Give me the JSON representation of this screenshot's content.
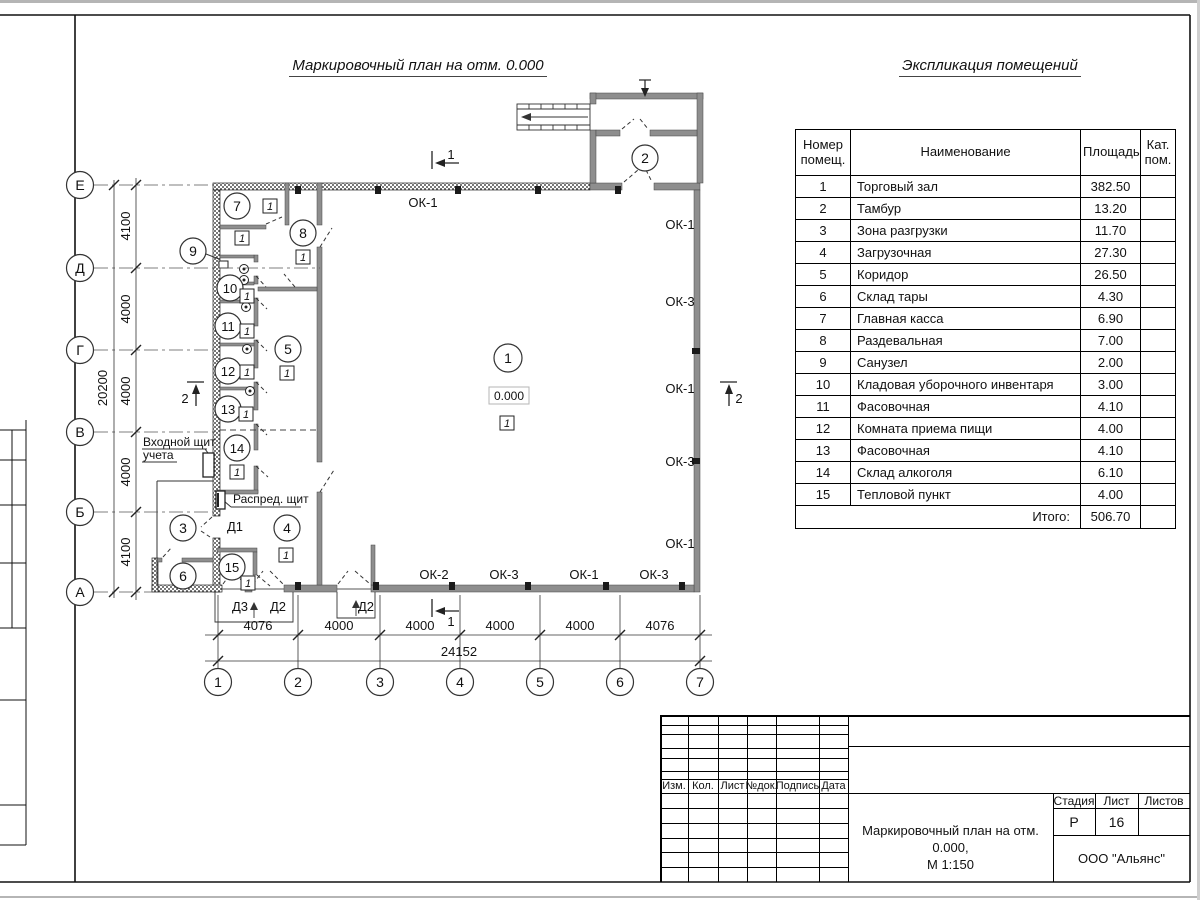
{
  "titles": {
    "plan": "Маркировочный план на отм. 0.000",
    "explication": "Экспликация помещений"
  },
  "explication": {
    "header": {
      "number": "Номер помещ.",
      "name": "Наименование",
      "area": "Площадь",
      "category": "Кат. пом."
    },
    "rows": [
      {
        "n": "1",
        "name": "Торговый зал",
        "area": "382.50"
      },
      {
        "n": "2",
        "name": "Тамбур",
        "area": "13.20"
      },
      {
        "n": "3",
        "name": "Зона разгрузки",
        "area": "11.70"
      },
      {
        "n": "4",
        "name": "Загрузочная",
        "area": "27.30"
      },
      {
        "n": "5",
        "name": "Коридор",
        "area": "26.50"
      },
      {
        "n": "6",
        "name": "Склад тары",
        "area": "4.30"
      },
      {
        "n": "7",
        "name": "Главная касса",
        "area": "6.90"
      },
      {
        "n": "8",
        "name": "Раздевальная",
        "area": "7.00"
      },
      {
        "n": "9",
        "name": "Санузел",
        "area": "2.00"
      },
      {
        "n": "10",
        "name": "Кладовая уборочного инвентаря",
        "area": "3.00"
      },
      {
        "n": "11",
        "name": "Фасовочная",
        "area": "4.10"
      },
      {
        "n": "12",
        "name": "Комната приема пищи",
        "area": "4.00"
      },
      {
        "n": "13",
        "name": "Фасовочная",
        "area": "4.10"
      },
      {
        "n": "14",
        "name": "Склад алкоголя",
        "area": "6.10"
      },
      {
        "n": "15",
        "name": "Тепловой пункт",
        "area": "4.00"
      }
    ],
    "total_label": "Итого:",
    "total_value": "506.70"
  },
  "plan": {
    "elevation": "0.000",
    "door_tag": "1",
    "axes_bottom": [
      "1",
      "2",
      "3",
      "4",
      "5",
      "6",
      "7"
    ],
    "axes_left": [
      "Е",
      "Д",
      "Г",
      "В",
      "Б",
      "А"
    ],
    "dims_bottom": [
      "4076",
      "4000",
      "4000",
      "4000",
      "4000",
      "4076"
    ],
    "dim_bottom_total": "24152",
    "dims_left": [
      "4100",
      "4000",
      "4000",
      "4000",
      "4100"
    ],
    "dim_left_total": "20200",
    "marks": {
      "ok1": "ОК-1",
      "ok2": "ОК-2",
      "ok3": "ОК-3",
      "d1": "Д1",
      "d2": "Д2",
      "d3": "Д3"
    },
    "sections": {
      "s1": "1",
      "s2": "2"
    },
    "notes": {
      "entry_panel_line1": "Входной щит",
      "entry_panel_line2": "учета",
      "distribution_panel": "Распред. щит"
    }
  },
  "titleblock": {
    "columns": [
      "Изм.",
      "Кол.",
      "Лист",
      "№док.",
      "Подпись",
      "Дата"
    ],
    "stage_label": "Стадия",
    "sheet_label": "Лист",
    "sheets_label": "Листов",
    "stage_value": "Р",
    "sheet_value": "16",
    "doc_title_line1": "Маркировочный план на отм. 0.000,",
    "doc_title_line2": "М 1:150",
    "company": "ООО \"Альянс\""
  }
}
